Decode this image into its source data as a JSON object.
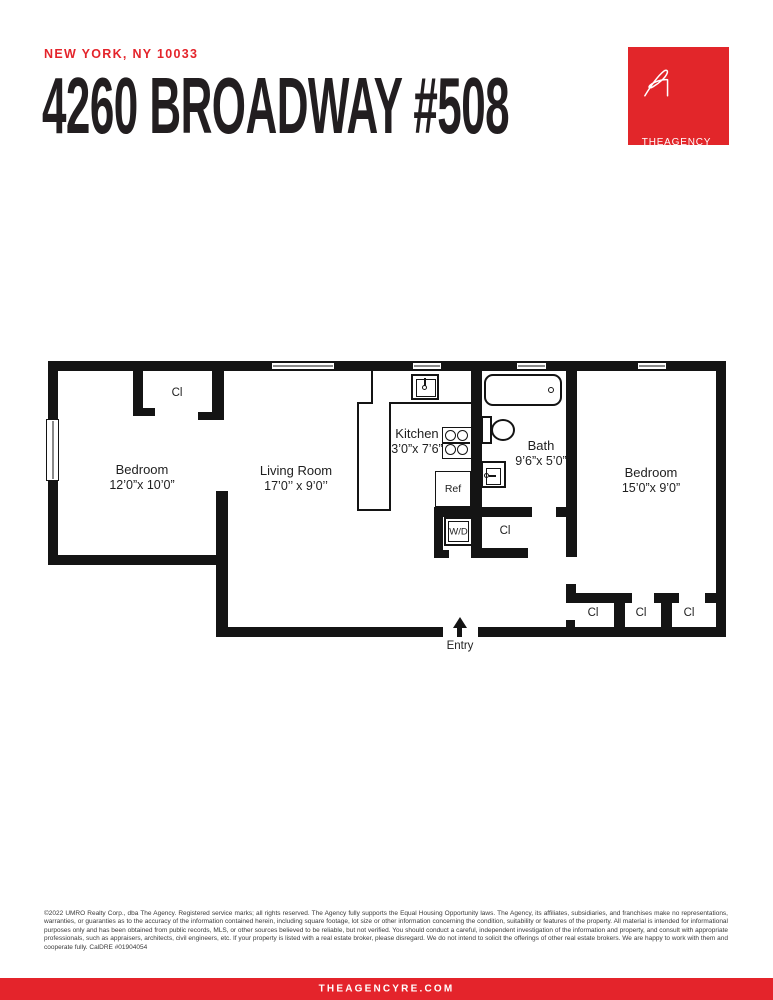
{
  "header": {
    "location": "NEW YORK, NY 10033",
    "title": "4260 BROADWAY #508"
  },
  "logo": {
    "brand": "THEAGENCY"
  },
  "colors": {
    "accent": "#e4242b",
    "logo_red": "#e2262a",
    "wall": "#141414"
  },
  "floorplan": {
    "rooms": [
      {
        "name": "Bedroom",
        "dims": "12’0”x 10’0”"
      },
      {
        "name": "Living Room",
        "dims": "17’0’’ x 9’0’’"
      },
      {
        "name": "Kitchen",
        "dims": "3’0”x 7’6”"
      },
      {
        "name": "Bath",
        "dims": "9’6”x 5’0”"
      },
      {
        "name": "Bedroom",
        "dims": "15’0”x 9’0”"
      }
    ],
    "closets": [
      "Cl",
      "Cl",
      "Cl",
      "Cl",
      "Cl"
    ],
    "fixtures": {
      "refrigerator": "Ref",
      "washer_dryer": "W/D"
    },
    "entry": "Entry"
  },
  "footer": {
    "legal": "©2022 UMRO Realty Corp., dba The Agency. Registered service marks; all rights reserved. The Agency fully supports the Equal Housing Opportunity laws. The Agency, its affiliates, subsidiaries, and franchises make no representations, warranties, or guaranties as to the accuracy of the information contained herein, including square footage, lot size or other information concerning the condition, suitability or features of the property. All material is intended for informational purposes only and has been obtained from public records, MLS, or other sources believed to be reliable, but not verified. You should conduct a careful, independent investigation of the information and property, and consult with appropriate professionals, such as appraisers, architects, civil engineers, etc. If your property is listed with a real estate broker, please disregard. We do not intend to solicit the offerings of other real estate brokers. We are happy to work with them and cooperate fully. CalDRE #01904054",
    "website": "THEAGENCYRE.COM"
  }
}
